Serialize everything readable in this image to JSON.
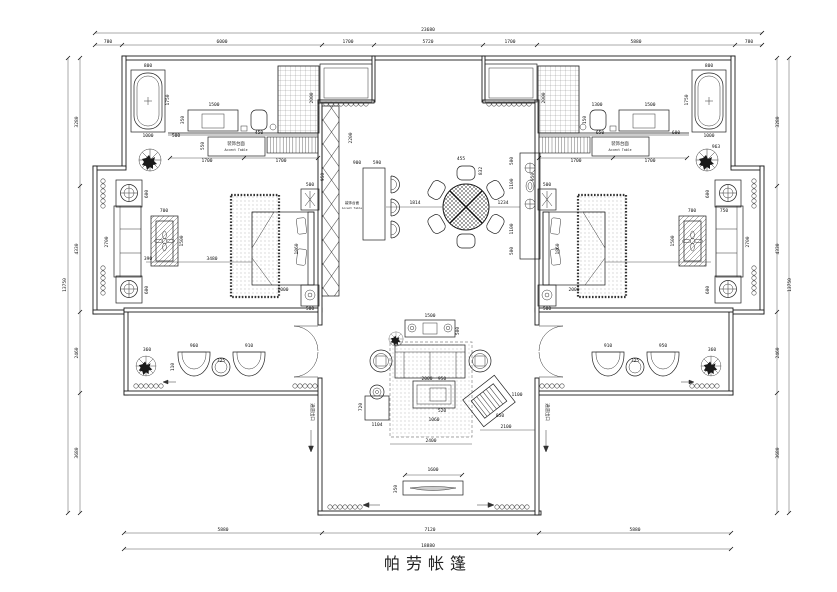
{
  "title": {
    "text": "帕劳帐篷"
  },
  "drawing": {
    "colors": {
      "line": "#1a1a1a",
      "background": "#ffffff"
    },
    "annotations": [
      {
        "text": "装饰台面",
        "x": 236,
        "y": 145,
        "size": 4.4
      },
      {
        "text": "Accent Table",
        "x": 236,
        "y": 151,
        "size": 3.2
      },
      {
        "text": "装饰台面",
        "x": 620,
        "y": 145,
        "size": 4.4
      },
      {
        "text": "Accent Table",
        "x": 620,
        "y": 151,
        "size": 3.2
      },
      {
        "text": "装饰台面",
        "x": 352,
        "y": 204,
        "size": 3.6
      },
      {
        "text": "Accent Table",
        "x": 352,
        "y": 209,
        "size": 2.8
      },
      {
        "text": "通道出口",
        "x": 311,
        "y": 412,
        "rot": 90,
        "size": 4.4
      },
      {
        "text": "通道出口",
        "x": 546,
        "y": 412,
        "rot": 90,
        "size": 4.4
      }
    ],
    "dimensions": [
      {
        "t": "23680",
        "x": 428,
        "y": 31
      },
      {
        "t": "780",
        "x": 108,
        "y": 43
      },
      {
        "t": "6000",
        "x": 222,
        "y": 43
      },
      {
        "t": "1700",
        "x": 348,
        "y": 43
      },
      {
        "t": "5720",
        "x": 428,
        "y": 43
      },
      {
        "t": "1700",
        "x": 510,
        "y": 43
      },
      {
        "t": "5880",
        "x": 636,
        "y": 43
      },
      {
        "t": "780",
        "x": 749,
        "y": 43
      },
      {
        "t": "5880",
        "x": 223,
        "y": 531
      },
      {
        "t": "7120",
        "x": 430,
        "y": 531
      },
      {
        "t": "5880",
        "x": 635,
        "y": 531
      },
      {
        "t": "18880",
        "x": 428,
        "y": 547
      },
      {
        "t": "3280",
        "x": 78,
        "y": 122,
        "r": -90
      },
      {
        "t": "4330",
        "x": 78,
        "y": 249,
        "r": -90
      },
      {
        "t": "2460",
        "x": 78,
        "y": 353,
        "r": -90
      },
      {
        "t": "3680",
        "x": 78,
        "y": 453,
        "r": -90
      },
      {
        "t": "13750",
        "x": 66,
        "y": 285,
        "r": -90
      },
      {
        "t": "3280",
        "x": 779,
        "y": 122,
        "r": -90
      },
      {
        "t": "4330",
        "x": 779,
        "y": 249,
        "r": -90
      },
      {
        "t": "2460",
        "x": 779,
        "y": 353,
        "r": -90
      },
      {
        "t": "3680",
        "x": 779,
        "y": 453,
        "r": -90
      },
      {
        "t": "13750",
        "x": 791,
        "y": 285,
        "r": -90
      },
      {
        "t": "800",
        "x": 148,
        "y": 67
      },
      {
        "t": "1750",
        "x": 169,
        "y": 100,
        "r": -90
      },
      {
        "t": "1000",
        "x": 148,
        "y": 137
      },
      {
        "t": "1500",
        "x": 214,
        "y": 106
      },
      {
        "t": "350",
        "x": 184,
        "y": 120,
        "r": -90
      },
      {
        "t": "500",
        "x": 176,
        "y": 137
      },
      {
        "t": "450",
        "x": 259,
        "y": 134
      },
      {
        "t": "2000",
        "x": 313,
        "y": 98,
        "r": -90
      },
      {
        "t": "550",
        "x": 204,
        "y": 146,
        "r": -90
      },
      {
        "t": "1700",
        "x": 207,
        "y": 162
      },
      {
        "t": "1700",
        "x": 281,
        "y": 162
      },
      {
        "t": "2200",
        "x": 352,
        "y": 138,
        "r": -90
      },
      {
        "t": "500",
        "x": 310,
        "y": 186
      },
      {
        "t": "950",
        "x": 324,
        "y": 177,
        "r": -90
      },
      {
        "t": "1860",
        "x": 298,
        "y": 249,
        "r": -90
      },
      {
        "t": "2000",
        "x": 283,
        "y": 291
      },
      {
        "t": "500",
        "x": 310,
        "y": 310
      },
      {
        "t": "600",
        "x": 148,
        "y": 194,
        "r": -90
      },
      {
        "t": "600",
        "x": 148,
        "y": 290,
        "r": -90
      },
      {
        "t": "2700",
        "x": 108,
        "y": 242,
        "r": -90
      },
      {
        "t": "700",
        "x": 164,
        "y": 212
      },
      {
        "t": "1500",
        "x": 183,
        "y": 241,
        "r": -90
      },
      {
        "t": "390",
        "x": 148,
        "y": 260
      },
      {
        "t": "3480",
        "x": 212,
        "y": 260
      },
      {
        "t": "900",
        "x": 357,
        "y": 164
      },
      {
        "t": "590",
        "x": 377,
        "y": 164
      },
      {
        "t": "1814",
        "x": 415,
        "y": 204
      },
      {
        "t": "455",
        "x": 461,
        "y": 160
      },
      {
        "t": "832",
        "x": 482,
        "y": 171,
        "r": -90
      },
      {
        "t": "1234",
        "x": 503,
        "y": 204
      },
      {
        "t": "500",
        "x": 513,
        "y": 161,
        "r": -90
      },
      {
        "t": "1100",
        "x": 513,
        "y": 184,
        "r": -90
      },
      {
        "t": "1100",
        "x": 513,
        "y": 229,
        "r": -90
      },
      {
        "t": "500",
        "x": 513,
        "y": 251,
        "r": -90
      },
      {
        "t": "1300",
        "x": 597,
        "y": 106
      },
      {
        "t": "1500",
        "x": 650,
        "y": 106
      },
      {
        "t": "150",
        "x": 586,
        "y": 120,
        "r": -90
      },
      {
        "t": "800",
        "x": 709,
        "y": 67
      },
      {
        "t": "1750",
        "x": 688,
        "y": 100,
        "r": -90
      },
      {
        "t": "1000",
        "x": 709,
        "y": 137
      },
      {
        "t": "650",
        "x": 600,
        "y": 134
      },
      {
        "t": "600",
        "x": 676,
        "y": 134
      },
      {
        "t": "2000",
        "x": 545,
        "y": 98,
        "r": -90
      },
      {
        "t": "1700",
        "x": 576,
        "y": 162
      },
      {
        "t": "1700",
        "x": 650,
        "y": 162
      },
      {
        "t": "963",
        "x": 716,
        "y": 148
      },
      {
        "t": "500",
        "x": 547,
        "y": 186
      },
      {
        "t": "950",
        "x": 534,
        "y": 177,
        "r": -90
      },
      {
        "t": "1860",
        "x": 559,
        "y": 249,
        "r": -90
      },
      {
        "t": "2000",
        "x": 574,
        "y": 291
      },
      {
        "t": "500",
        "x": 547,
        "y": 310
      },
      {
        "t": "600",
        "x": 709,
        "y": 194,
        "r": -90
      },
      {
        "t": "600",
        "x": 709,
        "y": 290,
        "r": -90
      },
      {
        "t": "2700",
        "x": 749,
        "y": 242,
        "r": -90
      },
      {
        "t": "750",
        "x": 724,
        "y": 212
      },
      {
        "t": "700",
        "x": 692,
        "y": 212
      },
      {
        "t": "1500",
        "x": 674,
        "y": 241,
        "r": -90
      },
      {
        "t": "360",
        "x": 147,
        "y": 351
      },
      {
        "t": "960",
        "x": 194,
        "y": 347
      },
      {
        "t": "110",
        "x": 174,
        "y": 367,
        "r": -90
      },
      {
        "t": "325",
        "x": 221,
        "y": 362
      },
      {
        "t": "910",
        "x": 249,
        "y": 347
      },
      {
        "t": "910",
        "x": 608,
        "y": 347
      },
      {
        "t": "325",
        "x": 635,
        "y": 362
      },
      {
        "t": "950",
        "x": 663,
        "y": 347
      },
      {
        "t": "360",
        "x": 712,
        "y": 351
      },
      {
        "t": "1500",
        "x": 430,
        "y": 317
      },
      {
        "t": "500",
        "x": 459,
        "y": 331,
        "r": -90
      },
      {
        "t": "2000",
        "x": 427,
        "y": 380
      },
      {
        "t": "950",
        "x": 442,
        "y": 380
      },
      {
        "t": "720",
        "x": 362,
        "y": 407,
        "r": -90
      },
      {
        "t": "1104",
        "x": 377,
        "y": 426
      },
      {
        "t": "1060",
        "x": 434,
        "y": 421
      },
      {
        "t": "520",
        "x": 442,
        "y": 412
      },
      {
        "t": "1100",
        "x": 517,
        "y": 396
      },
      {
        "t": "2100",
        "x": 506,
        "y": 428
      },
      {
        "t": "2400",
        "x": 431,
        "y": 442
      },
      {
        "t": "850",
        "x": 500,
        "y": 417
      },
      {
        "t": "1600",
        "x": 433,
        "y": 471
      },
      {
        "t": "350",
        "x": 397,
        "y": 489,
        "r": -90
      }
    ]
  }
}
